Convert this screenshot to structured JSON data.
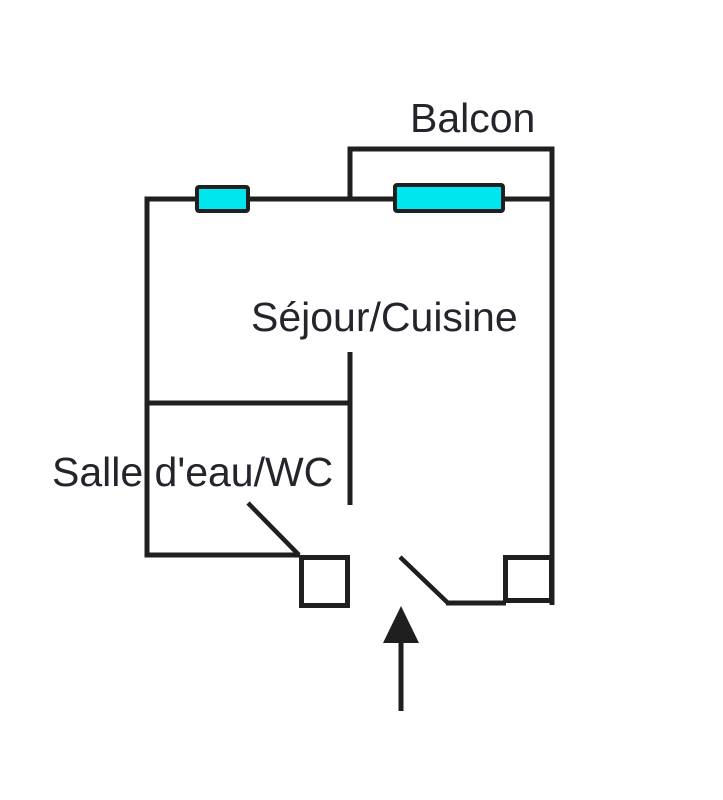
{
  "diagram": {
    "type": "apartment-floor-plan",
    "labels": {
      "balcony": "Balcon",
      "living_kitchen": "Séjour/Cuisine",
      "bathroom": "Salle d'eau/WC"
    },
    "colors": {
      "wall": "#1f1f1f",
      "window_fill": "#00e6ee",
      "text": "#24242c",
      "bg": "#ffffff"
    }
  }
}
